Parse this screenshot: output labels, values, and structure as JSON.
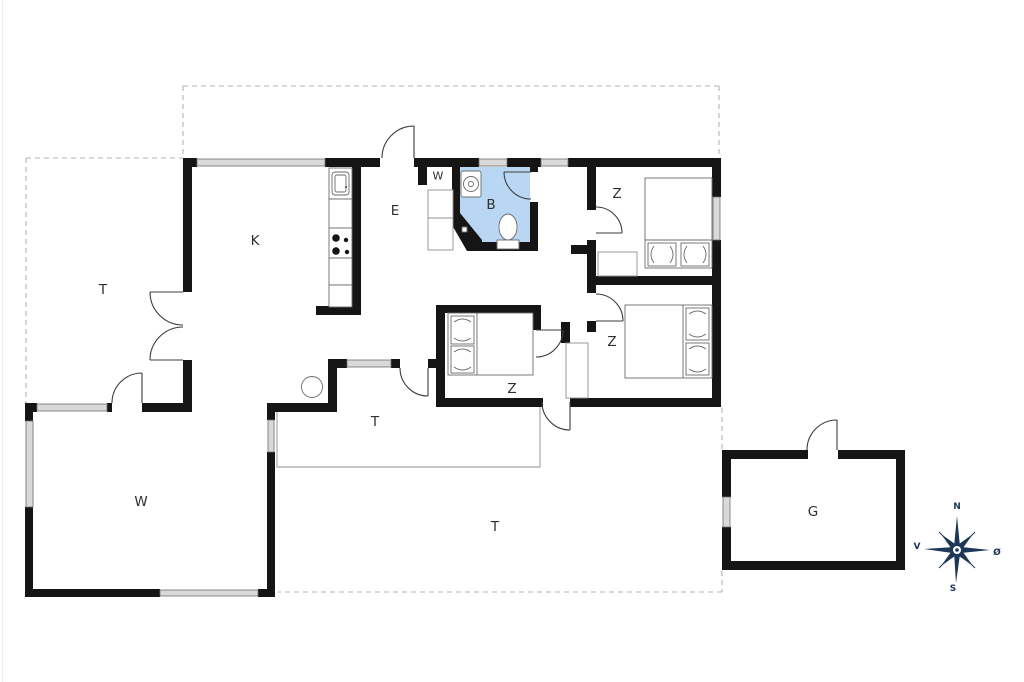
{
  "page": {
    "type": "house-floor-plan"
  },
  "colors": {
    "background": "#ffffff",
    "wall": "#151515",
    "window_fill": "#d9d9d9",
    "window_stroke": "#6e6e6e",
    "bathroom_floor": "#b9d7f2",
    "dashed_outline": "#b3b3b3",
    "thin_line": "#8f8f8f",
    "furniture": "#6b6b6b",
    "door": "#3c3c3c",
    "label": "#2f2f2f",
    "compass": "#1c3757"
  },
  "labels": {
    "rooms": [
      {
        "id": "kitchen",
        "text": "K"
      },
      {
        "id": "terrace-left",
        "text": "T"
      },
      {
        "id": "entrance-hall",
        "text": "E"
      },
      {
        "id": "wardrobe",
        "text": "W"
      },
      {
        "id": "bathroom",
        "text": "B"
      },
      {
        "id": "bedroom-ne",
        "text": "Z"
      },
      {
        "id": "bedroom-mid",
        "text": "Z"
      },
      {
        "id": "bedroom-se",
        "text": "Z"
      },
      {
        "id": "living-room",
        "text": "W"
      },
      {
        "id": "terrace-mid",
        "text": "T"
      },
      {
        "id": "terrace-south",
        "text": "T"
      },
      {
        "id": "garage",
        "text": "G"
      }
    ]
  },
  "compass": {
    "letters": [
      {
        "dir": "north",
        "text": "N"
      },
      {
        "dir": "south",
        "text": "S"
      },
      {
        "dir": "west",
        "text": "V"
      },
      {
        "dir": "east",
        "text": "Ø"
      }
    ]
  }
}
